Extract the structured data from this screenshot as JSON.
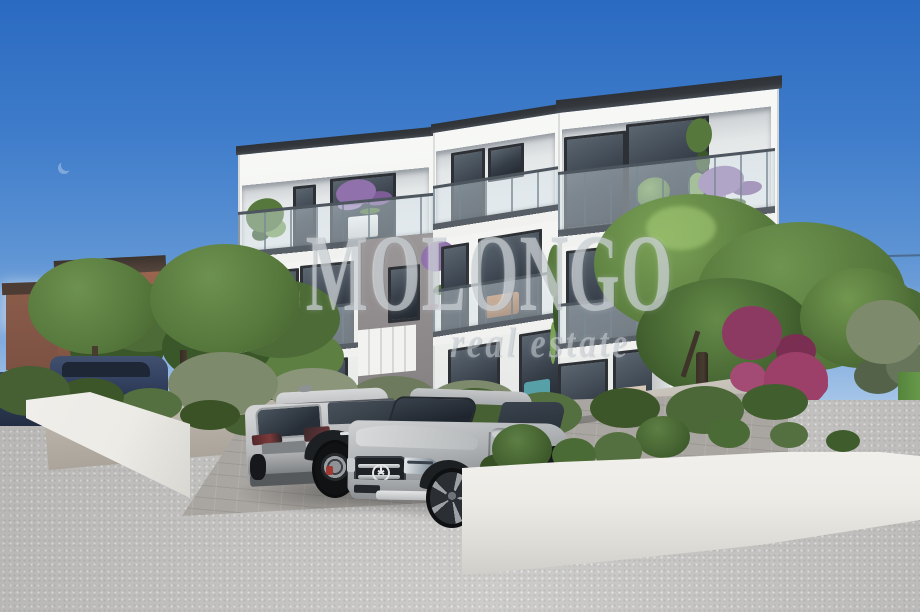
{
  "image": {
    "type": "3d-architectural-rendering",
    "description": "New modern white three-storey apartment building with glass balconies, landscaped garden, two SUVs parked on a paved driveway, blue sky"
  },
  "watermark": {
    "line1": "MOLONGO",
    "line2": "real estate"
  },
  "colors": {
    "sky_top": "#2a6ac1",
    "sky_mid": "#5b92d3",
    "sky_low": "#a6c6e8",
    "horizon": "#d6e4f2",
    "bldg_white": "#f3f4f2",
    "roof_dark": "#34383d",
    "win_frame": "#2d3135",
    "glass_light": "#c8d3da",
    "glass_dark": "#343c46",
    "recess_gray": "#8f8b8c",
    "slab_edge": "#575e66",
    "rail_tint": "rgba(214,226,233,0.45)",
    "green_mid": "#56783c",
    "green_light": "#7ba257",
    "green_dark": "#3a5729",
    "olive": "#7e8a6c",
    "hedge_dark": "#465f33",
    "purple": "#9071ab",
    "magenta": "#8d3a63",
    "terracotta": "#9a6450",
    "roof_red": "#95463a",
    "trunk": "#473c30",
    "pavement": "#c6c5c3",
    "paver": "#a9a5a0",
    "wall_white": "#edebe6",
    "grass": "#67994a",
    "car_silver": "#c3c4c5",
    "car_silver_dark": "#94979a",
    "car_navy": "#334160",
    "interior_warm": "#d9c9b8",
    "interior_teal": "#58a0a8"
  },
  "scene": {
    "background": [
      "blue sky",
      "terracotta neighbour houses left",
      "red-roof houses right",
      "power line"
    ],
    "building": {
      "storeys": 3,
      "blocks": 3,
      "features": [
        "flat dark roof caps",
        "glass balustrade terraces",
        "floor-to-ceiling windows",
        "potted plants and purple flowers on balconies",
        "grey recessed stair section"
      ]
    },
    "vehicles": [
      "silver SUV rear view",
      "silver Mercedes-type SUV front view",
      "two dark blue cars far left"
    ],
    "vegetation": [
      "two round pruned trees left",
      "large tree right",
      "slim cypress",
      "olive shrubs",
      "hedges",
      "magenta flowering shrub"
    ],
    "ground": [
      "grey asphalt driveway",
      "block-paver parking strip",
      "white curved garden walls",
      "green grass strip right"
    ]
  }
}
